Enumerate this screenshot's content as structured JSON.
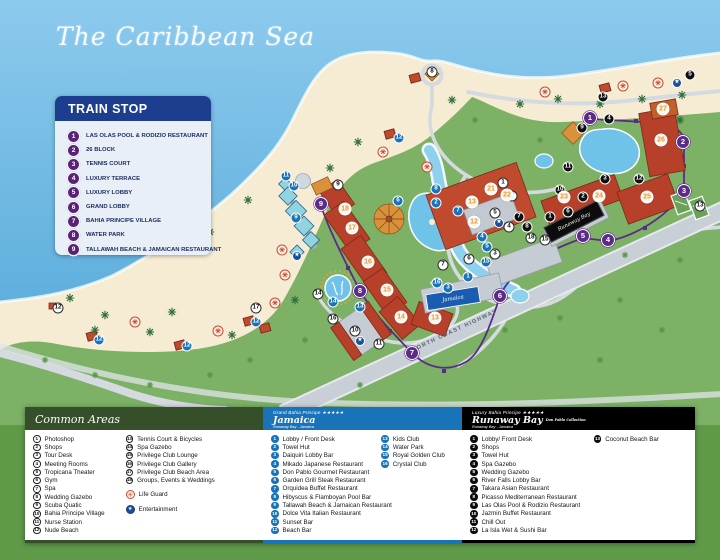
{
  "title": "The Caribbean Sea",
  "train_stop": {
    "title": "TRAIN STOP",
    "items": [
      "LAS OLAS POOL & RODIZIO RESTAURANT",
      "26 BLOCK",
      "TENNIS COURT",
      "LUXURY TERRACE",
      "LUXURY LOBBY",
      "GRAND LOBBY",
      "BAHIA PRINCIPE VILLAGE",
      "WATER PARK",
      "TALLAWAH BEACH & JAMAICAN RESTAURANT"
    ]
  },
  "map": {
    "highway_label": "NORTH COAST HIGHWAY",
    "signs": {
      "runaway": "Runaway Bay",
      "jamaica": "Jamaica"
    },
    "markers": {
      "train": [
        [
          1,
          590,
          118
        ],
        [
          2,
          683,
          142
        ],
        [
          3,
          684,
          191
        ],
        [
          4,
          608,
          240
        ],
        [
          5,
          583,
          236
        ],
        [
          6,
          500,
          296
        ],
        [
          7,
          412,
          353
        ],
        [
          8,
          360,
          291
        ],
        [
          9,
          321,
          204
        ]
      ],
      "jamaica": [
        [
          1,
          468,
          277
        ],
        [
          2,
          436,
          203
        ],
        [
          3,
          448,
          288
        ],
        [
          4,
          482,
          237
        ],
        [
          5,
          487,
          247
        ],
        [
          6,
          398,
          201
        ],
        [
          7,
          458,
          211
        ],
        [
          8,
          436,
          189
        ],
        [
          9,
          296,
          218
        ],
        [
          10,
          294,
          186
        ],
        [
          11,
          286,
          176
        ],
        [
          12,
          99,
          340
        ],
        [
          12,
          187,
          346
        ],
        [
          12,
          256,
          322
        ],
        [
          12,
          399,
          138
        ],
        [
          13,
          360,
          307
        ],
        [
          14,
          333,
          302
        ],
        [
          15,
          486,
          262
        ],
        [
          16,
          437,
          283
        ]
      ],
      "runaway": [
        [
          1,
          550,
          217
        ],
        [
          2,
          583,
          197
        ],
        [
          3,
          605,
          179
        ],
        [
          4,
          609,
          119
        ],
        [
          5,
          690,
          75
        ],
        [
          6,
          568,
          212
        ],
        [
          7,
          519,
          217
        ],
        [
          8,
          527,
          227
        ],
        [
          9,
          582,
          128
        ],
        [
          10,
          560,
          190
        ],
        [
          11,
          568,
          167
        ],
        [
          12,
          639,
          179
        ],
        [
          13,
          603,
          97
        ]
      ],
      "common": [
        [
          1,
          503,
          183
        ],
        [
          2,
          512,
          196
        ],
        [
          3,
          495,
          254
        ],
        [
          4,
          509,
          227
        ],
        [
          5,
          495,
          213
        ],
        [
          6,
          469,
          259
        ],
        [
          7,
          443,
          265
        ],
        [
          8,
          432,
          72
        ],
        [
          9,
          338,
          185
        ],
        [
          10,
          355,
          331
        ],
        [
          11,
          379,
          344
        ],
        [
          12,
          58,
          308
        ],
        [
          13,
          700,
          206
        ],
        [
          14,
          318,
          294
        ],
        [
          15,
          545,
          240
        ],
        [
          16,
          333,
          319
        ],
        [
          17,
          256,
          308
        ],
        [
          18,
          531,
          238
        ]
      ],
      "building": [
        [
          12,
          474,
          222
        ],
        [
          13,
          472,
          202
        ],
        [
          13,
          435,
          318
        ],
        [
          14,
          401,
          317
        ],
        [
          15,
          387,
          290
        ],
        [
          16,
          368,
          262
        ],
        [
          17,
          352,
          228
        ],
        [
          18,
          345,
          209
        ],
        [
          21,
          491,
          189
        ],
        [
          22,
          507,
          195
        ],
        [
          23,
          564,
          197
        ],
        [
          24,
          599,
          196
        ],
        [
          25,
          647,
          197
        ],
        [
          26,
          661,
          140
        ],
        [
          27,
          663,
          109
        ]
      ],
      "lifeguard": [
        [
          282,
          250
        ],
        [
          285,
          275
        ],
        [
          135,
          322
        ],
        [
          218,
          331
        ],
        [
          275,
          303
        ],
        [
          383,
          152
        ],
        [
          427,
          167
        ],
        [
          545,
          92
        ],
        [
          623,
          86
        ],
        [
          658,
          83
        ]
      ],
      "entertainment": [
        [
          297,
          256
        ],
        [
          360,
          341
        ],
        [
          677,
          83
        ],
        [
          499,
          223
        ]
      ]
    },
    "decor": {
      "palms": [
        [
          105,
          315
        ],
        [
          150,
          332
        ],
        [
          232,
          335
        ],
        [
          295,
          300
        ],
        [
          330,
          168
        ],
        [
          358,
          142
        ],
        [
          452,
          100
        ],
        [
          520,
          104
        ],
        [
          558,
          99
        ],
        [
          600,
          104
        ],
        [
          642,
          99
        ],
        [
          682,
          95
        ],
        [
          172,
          312
        ],
        [
          70,
          298
        ],
        [
          248,
          200
        ],
        [
          210,
          232
        ],
        [
          95,
          330
        ],
        [
          680,
          120
        ]
      ],
      "tufts": [
        [
          45,
          360
        ],
        [
          95,
          375
        ],
        [
          150,
          385
        ],
        [
          250,
          360
        ],
        [
          305,
          340
        ],
        [
          505,
          330
        ],
        [
          560,
          318
        ],
        [
          620,
          300
        ],
        [
          662,
          330
        ],
        [
          210,
          375
        ],
        [
          360,
          385
        ],
        [
          600,
          360
        ],
        [
          680,
          260
        ],
        [
          540,
          140
        ],
        [
          625,
          255
        ],
        [
          475,
          120
        ]
      ],
      "huts": [
        [
          390,
          134
        ],
        [
          92,
          336
        ],
        [
          180,
          345
        ],
        [
          249,
          321
        ],
        [
          265,
          328
        ],
        [
          605,
          88
        ],
        [
          415,
          78
        ]
      ]
    }
  },
  "legend": {
    "common": {
      "title": "Common Areas",
      "items": [
        "Photoshop",
        "Shops",
        "Tour Desk",
        "Meeting Rooms",
        "Tropicana Theater",
        "Gym",
        "Spa",
        "Wedding Gazebo",
        "Scuba Quatic",
        "Bahia Principe Village",
        "Nurse Station",
        "Nude Beach",
        "Tennis Court & Bicycles",
        "Spa Gazebo",
        "Privilege Club Lounge",
        "Privilege Club Gallery",
        "Privilege Club Beach Area",
        "Groups, Events & Weddings"
      ],
      "special": [
        {
          "icon": "life-guard-icon",
          "glyph": "✳",
          "label": "Life Guard"
        },
        {
          "icon": "entertainment-icon",
          "glyph": "★",
          "label": "Entertainment"
        }
      ]
    },
    "jamaica": {
      "brand": "Grand Bahia Principe",
      "stars": "★★★★★",
      "name": "Jamaica",
      "location": "Runaway Bay - Jamaica",
      "items": [
        "Lobby / Front Desk",
        "Towel Hut",
        "Daiquiri Lobby Bar",
        "Mikado Japanese Restaurant",
        "Don Pablo Gourmet Restaurant",
        "Garden Grill Steak Restaurant",
        "Orquidea Buffet Restaurant",
        "Hibyscus & Flamboyan Pool Bar",
        "Tallawah Beach & Jamaican Restaurant",
        "Dolce Vita Italian Restaurant",
        "Sunset Bar",
        "Beach Bar",
        "Kids Club",
        "Water Park",
        "Royal Golden Club",
        "Crystal Club"
      ]
    },
    "runaway": {
      "brand": "Luxury Bahia Principe",
      "stars": "★★★★★",
      "name": "Runaway Bay",
      "collection": "Don Pablo Collection",
      "location": "Runaway Bay - Jamaica",
      "items": [
        "Lobby/ Front Desk",
        "Shops",
        "Towel Hut",
        "Spa Gazebo",
        "Wedding Gazebo",
        "River Falls Lobby Bar",
        "Takara Asian Restaurant",
        "Picasso Mediterranean Restaurant",
        "Las Olas Pool & Rodizio Restaurant",
        "Jazmin Buffet Restaurant",
        "Chill Out",
        "La Isla Wet & Sushi Bar",
        "Coconut Beach Bar"
      ]
    }
  },
  "colors": {
    "sea": "#7fc1e8",
    "sand": "#f6ecd3",
    "land": "#7cb166",
    "train_purple": "#5b2b86",
    "jamaica_blue": "#1973b8",
    "runaway_black": "#0c0c0c",
    "building_orange": "#e8952d",
    "lifeguard_red": "#c94a2e",
    "entertainment_blue": "#1a4f9c"
  }
}
